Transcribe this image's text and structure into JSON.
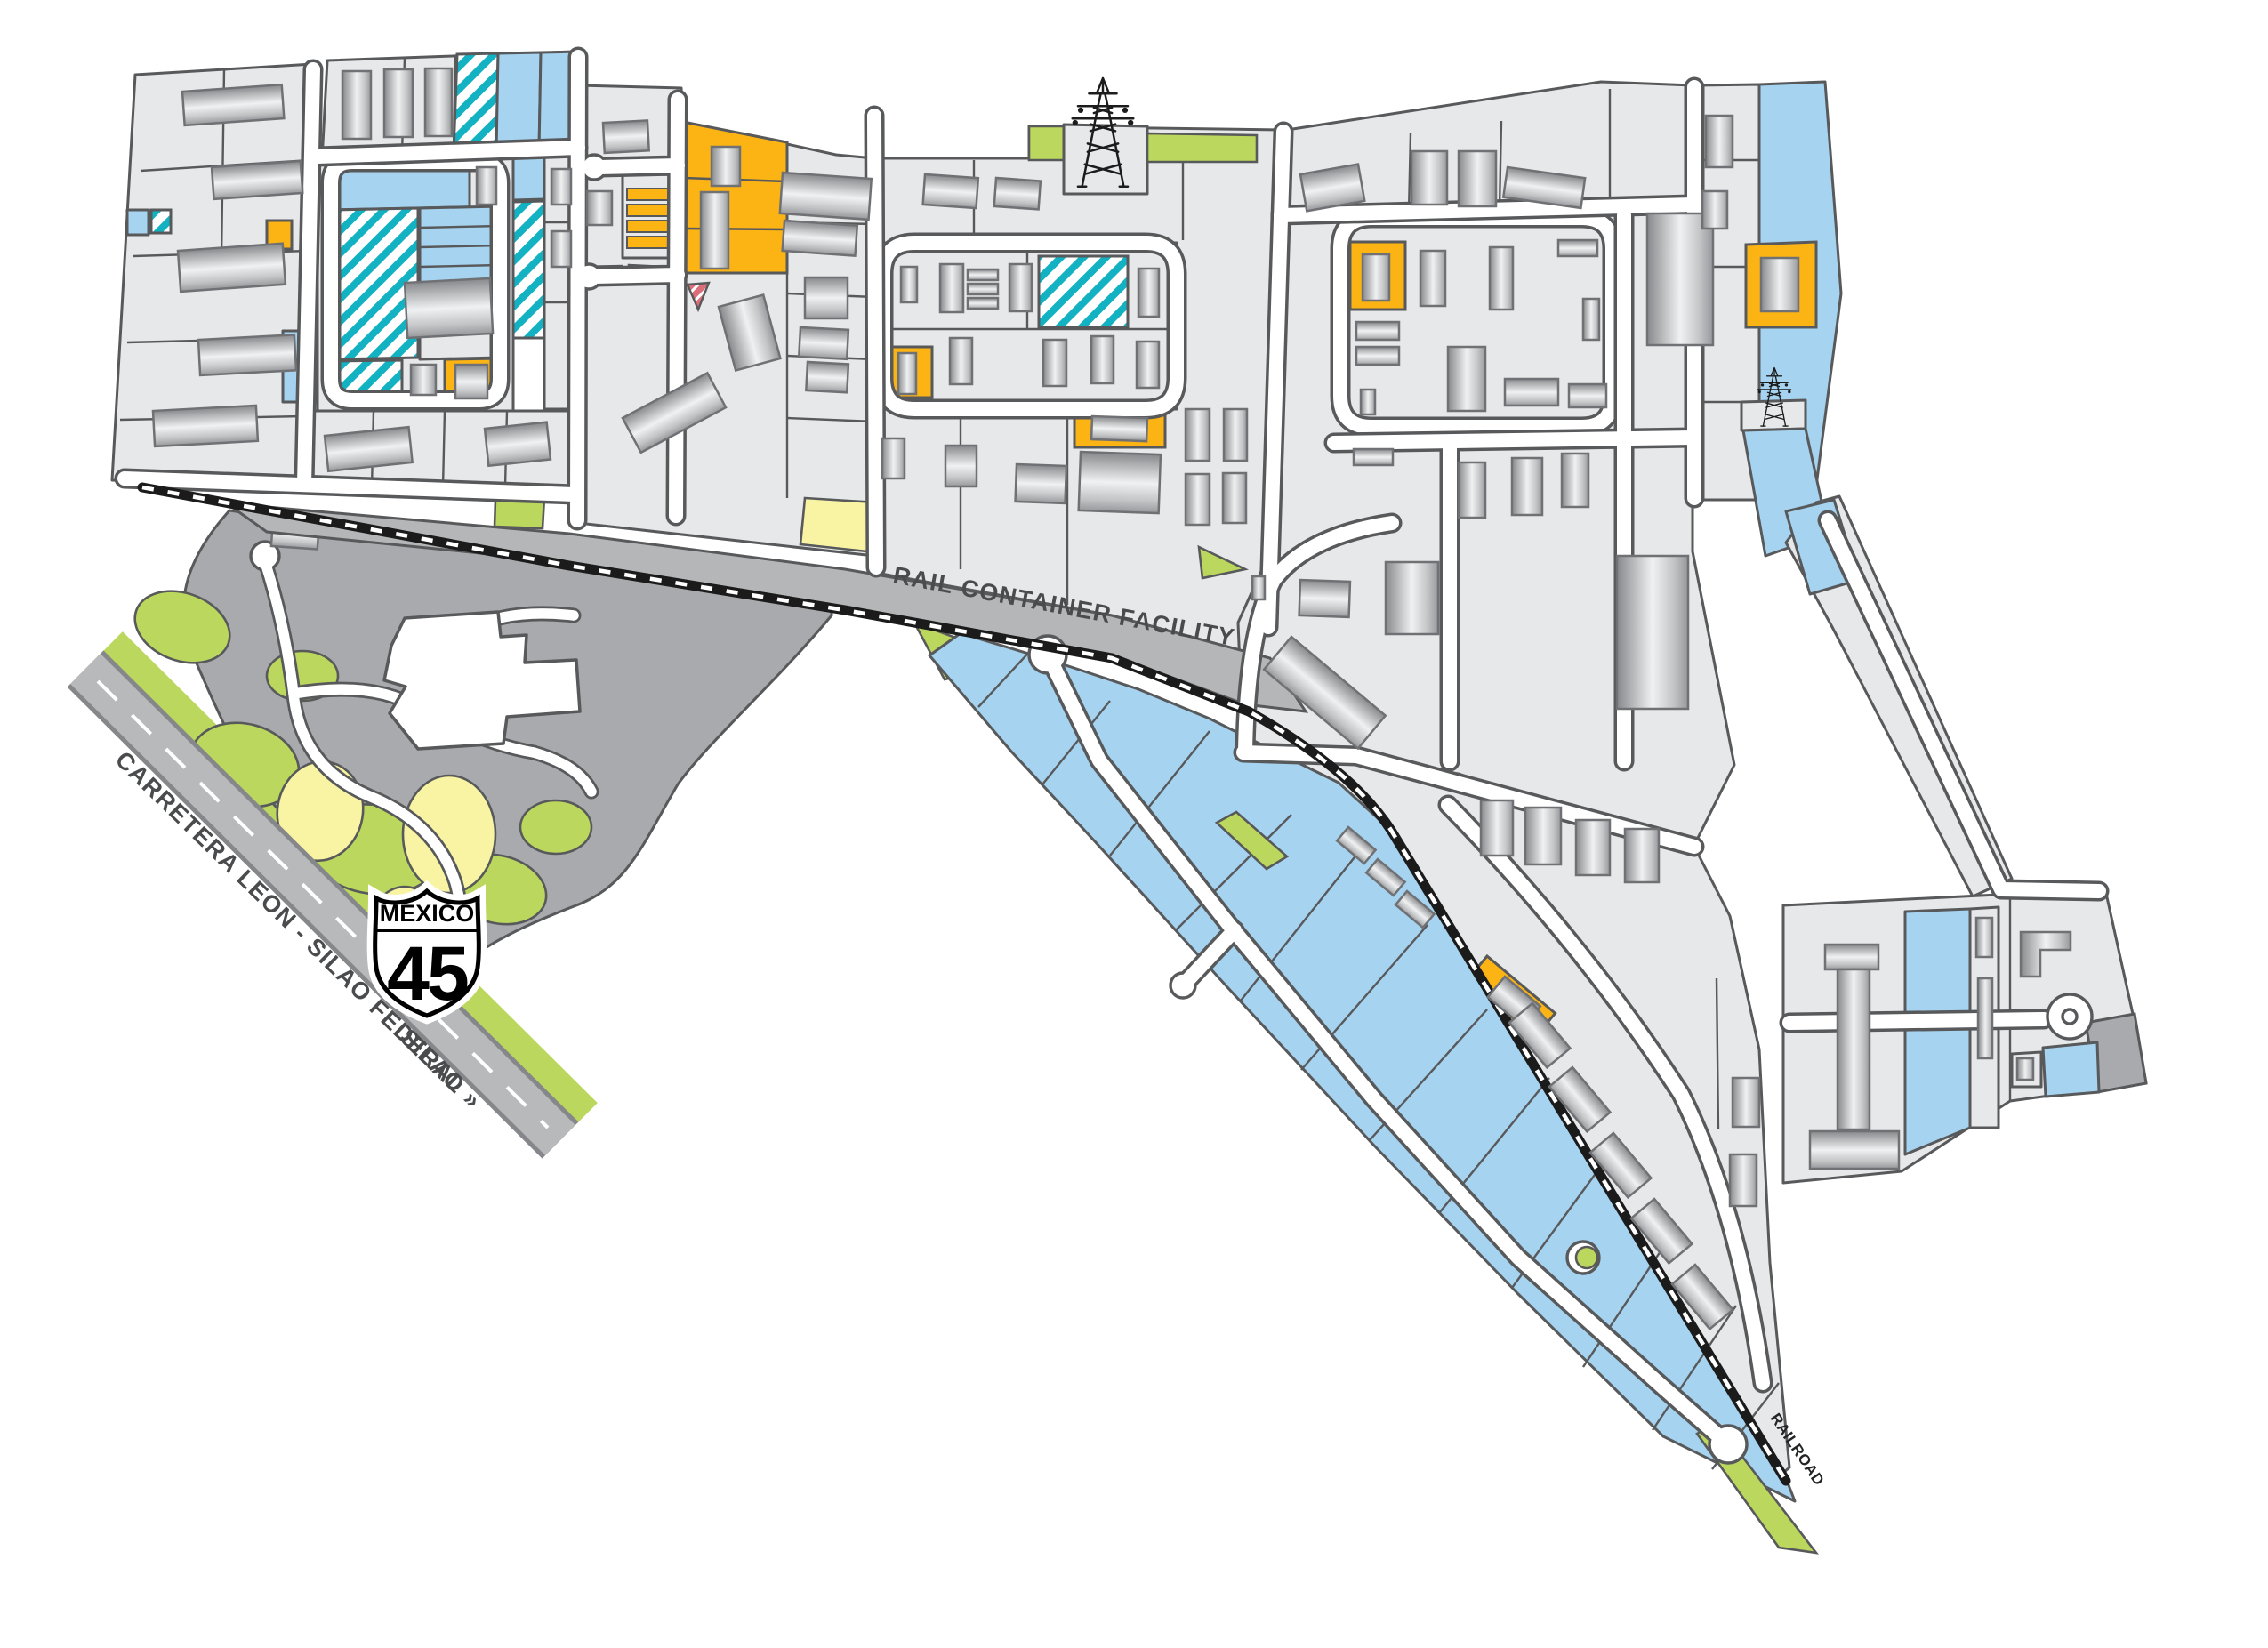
{
  "page": {
    "description": "Industrial park master-plan map with rail container facility, federal highway and color-coded land parcels"
  },
  "labels": {
    "rail_facility": "RAIL CONTAINER FACILITY",
    "railroad": "RAILROAD",
    "highway_name": "CARRETERA LEON - SILAO FEDERAL",
    "highway_direction": "SILAO »",
    "shield_country": "MEXICO",
    "shield_route_number": "45"
  },
  "colors": {
    "c-parcel": "#e7e8e9",
    "c-parcel-line": "#58595b",
    "c-blue": "#a6d3f0",
    "c-teal": "#12b2c3",
    "c-orange": "#fcb415",
    "c-green": "#bcd75e",
    "c-yellow": "#f8f4a4",
    "c-civic": "#a8aaad",
    "c-railband": "#b4b6b8",
    "c-red": "#dd6e79",
    "c-road": "#ffffff",
    "c-rail-black": "#1b1b1b",
    "c-building-line": "#707174",
    "c-label-text": "#4a4b4d",
    "c-shield-text": "#000000"
  },
  "icons": {
    "transmission_tower_count": 2
  }
}
